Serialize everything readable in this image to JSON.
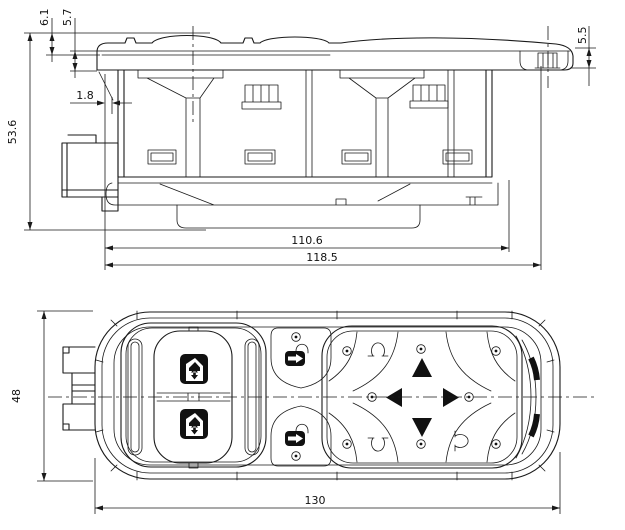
{
  "document": {
    "kind": "technical-drawing",
    "subject": "power-window-master-switch-assembly",
    "views": [
      "side-elevation",
      "top-plan"
    ]
  },
  "dims": {
    "d61": "6.1",
    "d57": "5.7",
    "d55": "5.5",
    "d18": "1.8",
    "d536": "53.6",
    "d1106": "110.6",
    "d1185": "118.5",
    "d48": "48",
    "d130": "130"
  },
  "icons": {
    "window_lift": "door-with-up-down-arrows",
    "door_lock": "lock-body-with-arrow-and-shackle",
    "mirror_select": "omega-mirror-glyph",
    "mirror_adjust": "solid-triangle-arrows",
    "screw": "circle-with-center-dot"
  },
  "colors": {
    "line": "#1a1a1a",
    "icon_fill": "#111111",
    "background": "#ffffff"
  }
}
